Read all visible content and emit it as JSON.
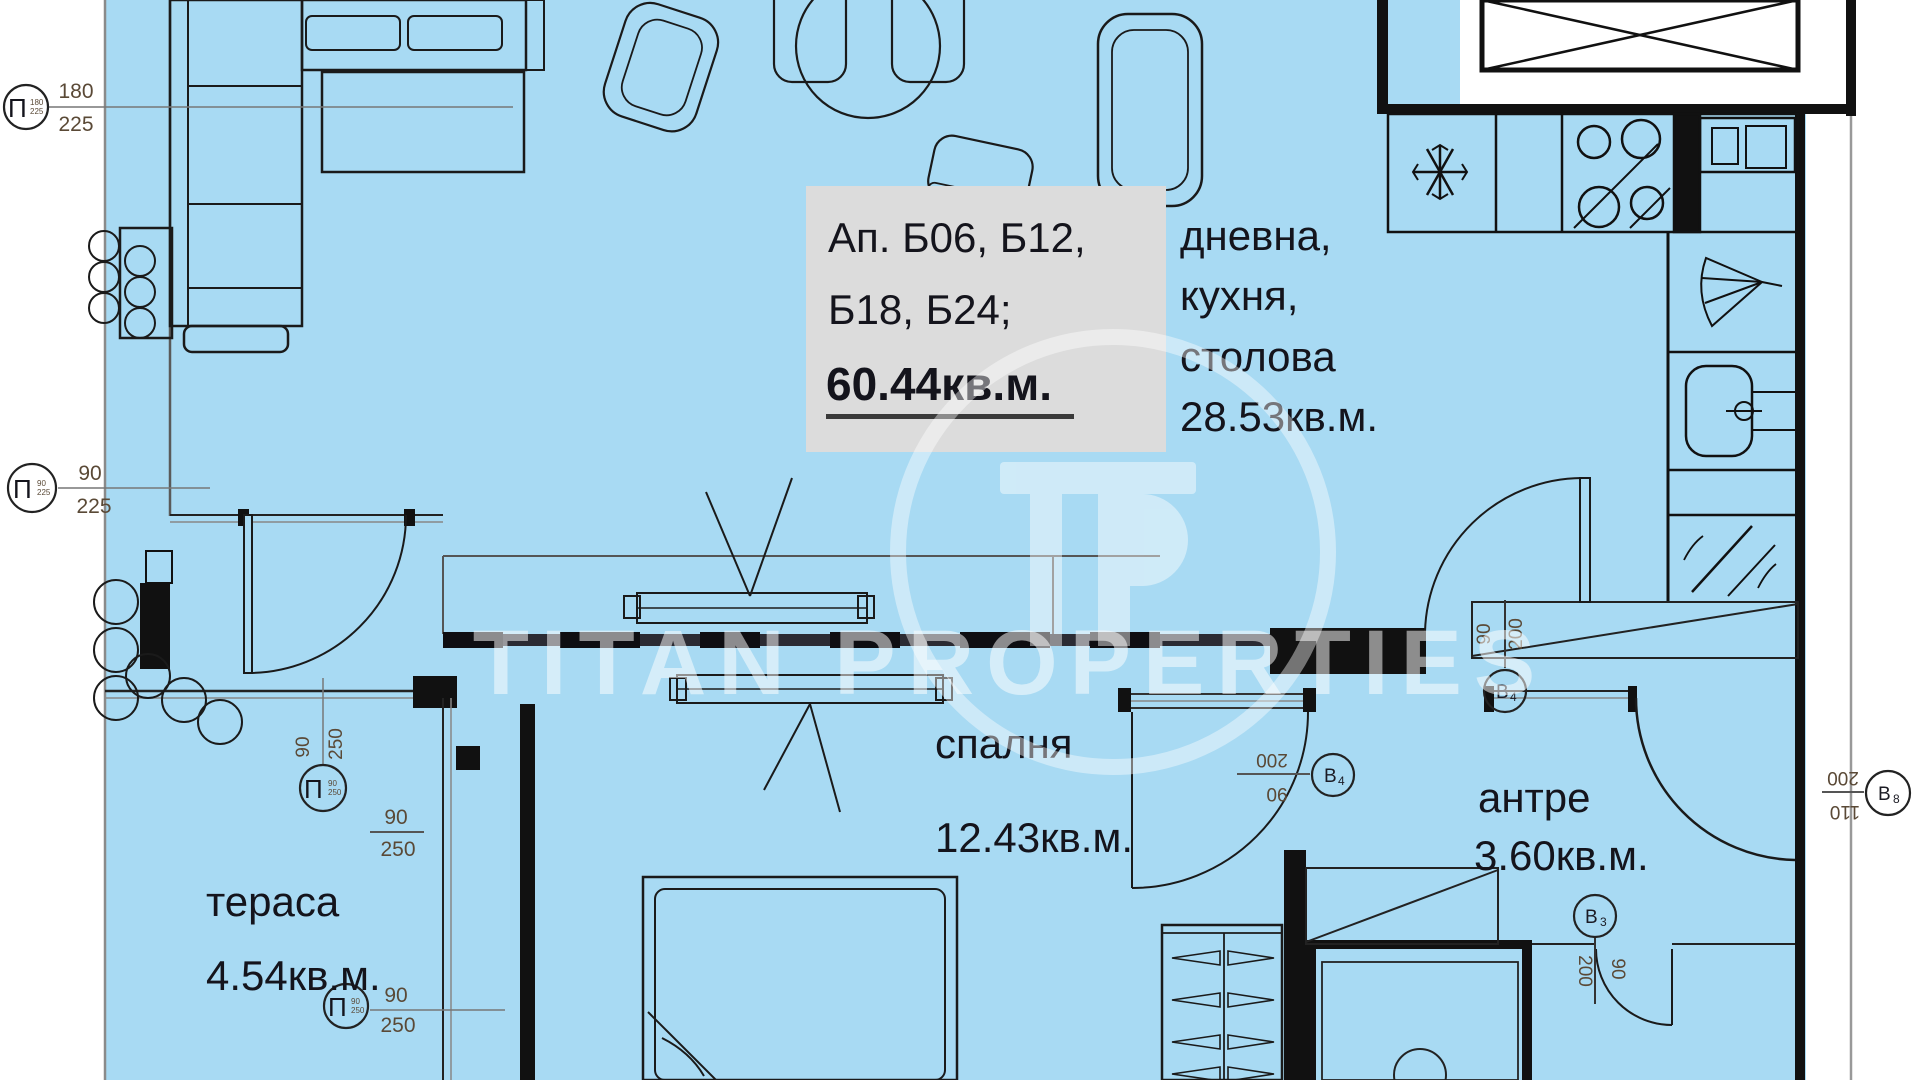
{
  "watermark": {
    "logo": "TP",
    "brand": "TITAN PROPERTIES"
  },
  "unit_box": {
    "line1": "Ап. Б06, Б12,",
    "line2": "Б18, Б24;",
    "area": "60.44кв.м."
  },
  "rooms": {
    "living": {
      "l1": "дневна,",
      "l2": "кухня,",
      "l3": "столова",
      "area": "28.53кв.м."
    },
    "bedroom": {
      "name": "спалня",
      "area": "12.43кв.м."
    },
    "hall": {
      "name": "антре",
      "area": "3.60кв.м."
    },
    "terrace": {
      "name": "тераса",
      "area": "4.54кв.м."
    }
  },
  "markers": {
    "p1": {
      "sym": "П",
      "top": "180",
      "bottom": "225",
      "inner_top": "180",
      "inner_bottom": "225"
    },
    "p2": {
      "sym": "П",
      "top": "90",
      "bottom": "225",
      "inner_top": "90",
      "inner_bottom": "225"
    },
    "p3": {
      "sym": "П",
      "left": "90",
      "right": "250",
      "inner_top": "90",
      "inner_bottom": "250"
    },
    "p4": {
      "sym": "П",
      "top": "90",
      "bottom": "250",
      "inner_top": "90",
      "inner_bottom": "250"
    },
    "f1": {
      "top": "90",
      "bottom": "250"
    },
    "b4a": {
      "label": "B",
      "sub": "4",
      "left": "90",
      "right": "200"
    },
    "b4b": {
      "label": "B",
      "sub": "4",
      "top": "200",
      "bottom": "90"
    },
    "b3": {
      "label": "B",
      "sub": "3",
      "left": "200",
      "right": "90"
    },
    "b8": {
      "label": "B",
      "sub": "8",
      "top": "200",
      "bottom": "110"
    }
  },
  "icons": {
    "fridge": "snowflake-icon",
    "stove": "burners-icon",
    "extractor": "fan-icon",
    "sink": "sink-icon",
    "mirror": "mirror-icon",
    "washing_machine": "washing-machine-icon",
    "hangers": "hanger-icon"
  },
  "colors": {
    "floor": "#a8daf3",
    "label_box": "#dcdcdc",
    "wall": "#111111",
    "dim_text": "#5a4936",
    "watermark": "#ffffff"
  }
}
